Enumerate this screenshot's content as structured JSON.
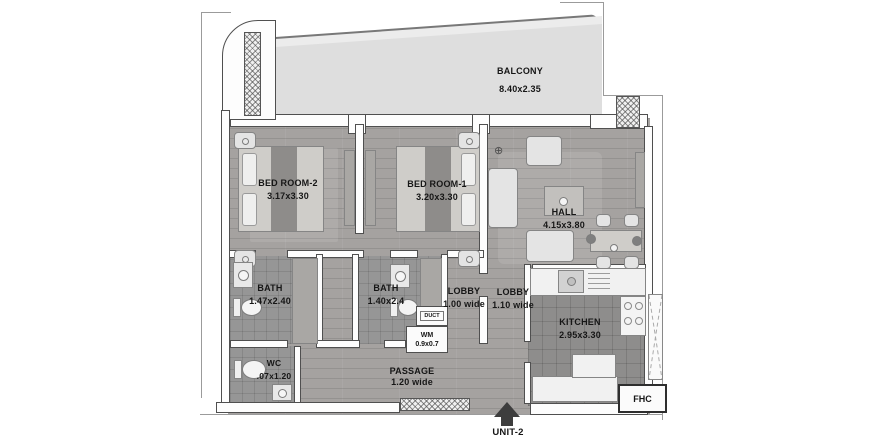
{
  "unit": {
    "label": "UNIT-2"
  },
  "fhc": {
    "label": "FHC"
  },
  "rooms": {
    "balcony": {
      "name": "BALCONY",
      "dims": "8.40x2.35"
    },
    "bedroom2": {
      "name": "BED ROOM-2",
      "dims": "3.17x3.30"
    },
    "bedroom1": {
      "name": "BED ROOM-1",
      "dims": "3.20x3.30"
    },
    "hall": {
      "name": "HALL",
      "dims": "4.15x3.80"
    },
    "bath1": {
      "name": "BATH",
      "dims": "1.47x2.40"
    },
    "bath2": {
      "name": "BATH",
      "dims": "1.40x2.4"
    },
    "lobby1": {
      "name": "LOBBY",
      "dims": "1.00 wide"
    },
    "lobby2": {
      "name": "LOBBY",
      "dims": "1.10 wide"
    },
    "kitchen": {
      "name": "KITCHEN",
      "dims": "2.95x3.30"
    },
    "wc": {
      "name": "WC",
      "dims": ".07x1.20"
    },
    "wm": {
      "name": "WM",
      "dims": "0.9x0.7"
    },
    "duct": {
      "name": "DUCT"
    },
    "passage": {
      "name": "PASSAGE",
      "dims": "1.20 wide"
    }
  },
  "colors": {
    "background": "#ffffff",
    "wall_outline": "#4f4f4f",
    "wood_floor": "#a5a2a0",
    "tile_floor": "#969696",
    "balcony_floor": "#dedede",
    "text": "#161616",
    "arrow": "#3d3d3d"
  }
}
